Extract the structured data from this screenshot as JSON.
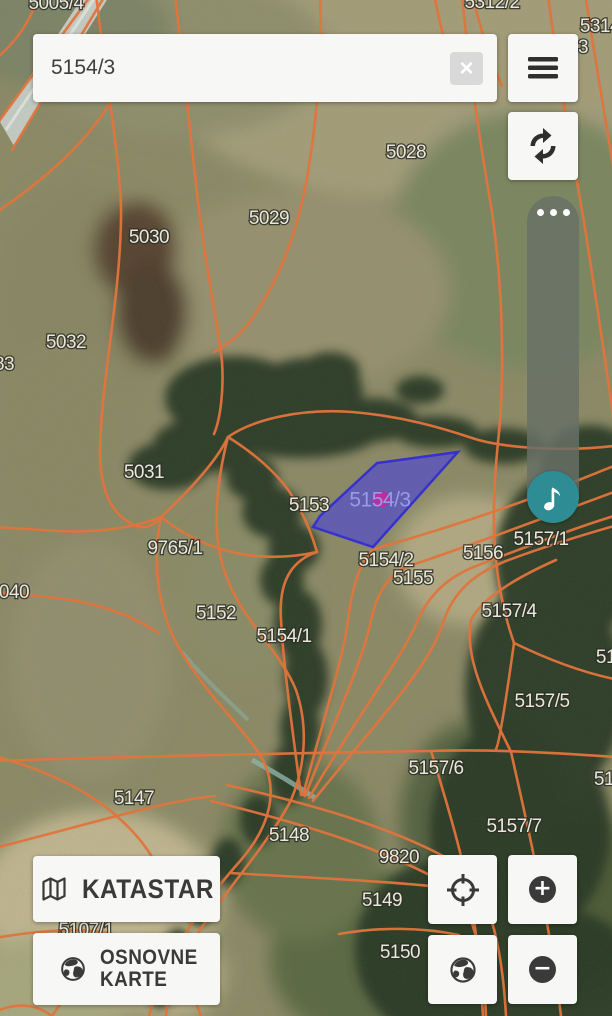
{
  "search": {
    "value": "5154/3"
  },
  "icons": {
    "clear": "×",
    "zoom_in": "+",
    "zoom_out": "−"
  },
  "buttons": {
    "katastar_label": "KATASTAR",
    "osnovne_line1": "OSNOVNE",
    "osnovne_line2": "KARTE"
  },
  "map": {
    "boundary_color": "#e1743c",
    "selected_parcel": {
      "label": "5154/3",
      "fill": "rgba(71,62,226,0.58)",
      "stroke": "rgba(52,45,210,0.95)",
      "marker_color": "rgba(187,45,156,0.9)"
    },
    "parcel_labels": [
      {
        "label": "5005/4",
        "x": 56,
        "y": 4
      },
      {
        "label": "5312/2",
        "x": 492,
        "y": 3
      },
      {
        "label": "5314",
        "x": 600,
        "y": 27
      },
      {
        "label": "3",
        "x": 583,
        "y": 48
      },
      {
        "label": "5028",
        "x": 406,
        "y": 153
      },
      {
        "label": "5029",
        "x": 269,
        "y": 219
      },
      {
        "label": "5030",
        "x": 149,
        "y": 238
      },
      {
        "label": "5032",
        "x": 66,
        "y": 343
      },
      {
        "label": "83",
        "x": 4,
        "y": 365
      },
      {
        "label": "5031",
        "x": 144,
        "y": 473
      },
      {
        "label": "5153",
        "x": 309,
        "y": 506
      },
      {
        "label": "9765/1",
        "x": 175,
        "y": 549
      },
      {
        "label": "5157/1",
        "x": 541,
        "y": 540
      },
      {
        "label": "5156",
        "x": 483,
        "y": 554
      },
      {
        "label": "5154/2",
        "x": 386,
        "y": 561
      },
      {
        "label": "040",
        "x": 14,
        "y": 593
      },
      {
        "label": "5155",
        "x": 413,
        "y": 579
      },
      {
        "label": "5157/4",
        "x": 509,
        "y": 612
      },
      {
        "label": "5152",
        "x": 216,
        "y": 614
      },
      {
        "label": "5154/1",
        "x": 284,
        "y": 637
      },
      {
        "label": "51",
        "x": 606,
        "y": 658
      },
      {
        "label": "5157/5",
        "x": 542,
        "y": 702
      },
      {
        "label": "5157/6",
        "x": 436,
        "y": 769
      },
      {
        "label": "51",
        "x": 604,
        "y": 780
      },
      {
        "label": "5147",
        "x": 134,
        "y": 799
      },
      {
        "label": "5157/7",
        "x": 514,
        "y": 827
      },
      {
        "label": "5148",
        "x": 289,
        "y": 836
      },
      {
        "label": "9820",
        "x": 399,
        "y": 858
      },
      {
        "label": "5149",
        "x": 382,
        "y": 901
      },
      {
        "label": "5107/1",
        "x": 86,
        "y": 931
      },
      {
        "label": "5150",
        "x": 400,
        "y": 953
      }
    ]
  },
  "colors": {
    "slider_track": "rgba(103,112,102,0.83)",
    "slider_thumb": "#2e8d94",
    "button_background": "#f7f7f5",
    "icon_color": "#3a3a3a"
  }
}
